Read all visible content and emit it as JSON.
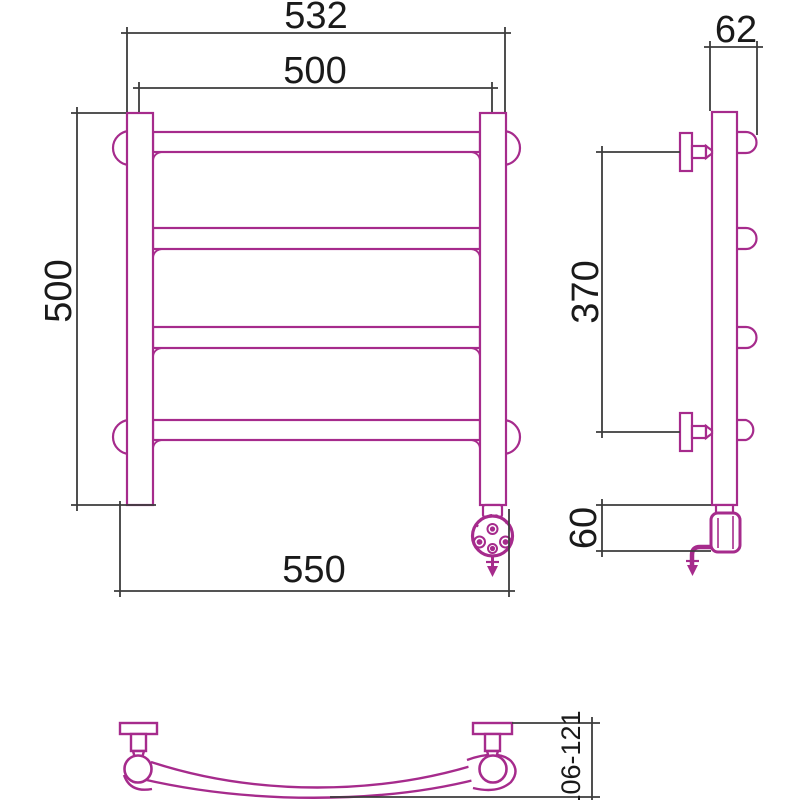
{
  "drawing": {
    "dimensions": {
      "front_overall_width": "532",
      "front_center_width": "500",
      "front_height": "500",
      "front_bottom_width": "550",
      "side_depth": "62",
      "side_bracket_spacing": "370",
      "side_heater_height": "60",
      "plan_depth_range": "106-121"
    },
    "colors": {
      "product_line": "#A62B8C",
      "dimension_line": "#3C3C3C",
      "text": "#1A1A1A",
      "background": "#FFFFFF"
    }
  }
}
